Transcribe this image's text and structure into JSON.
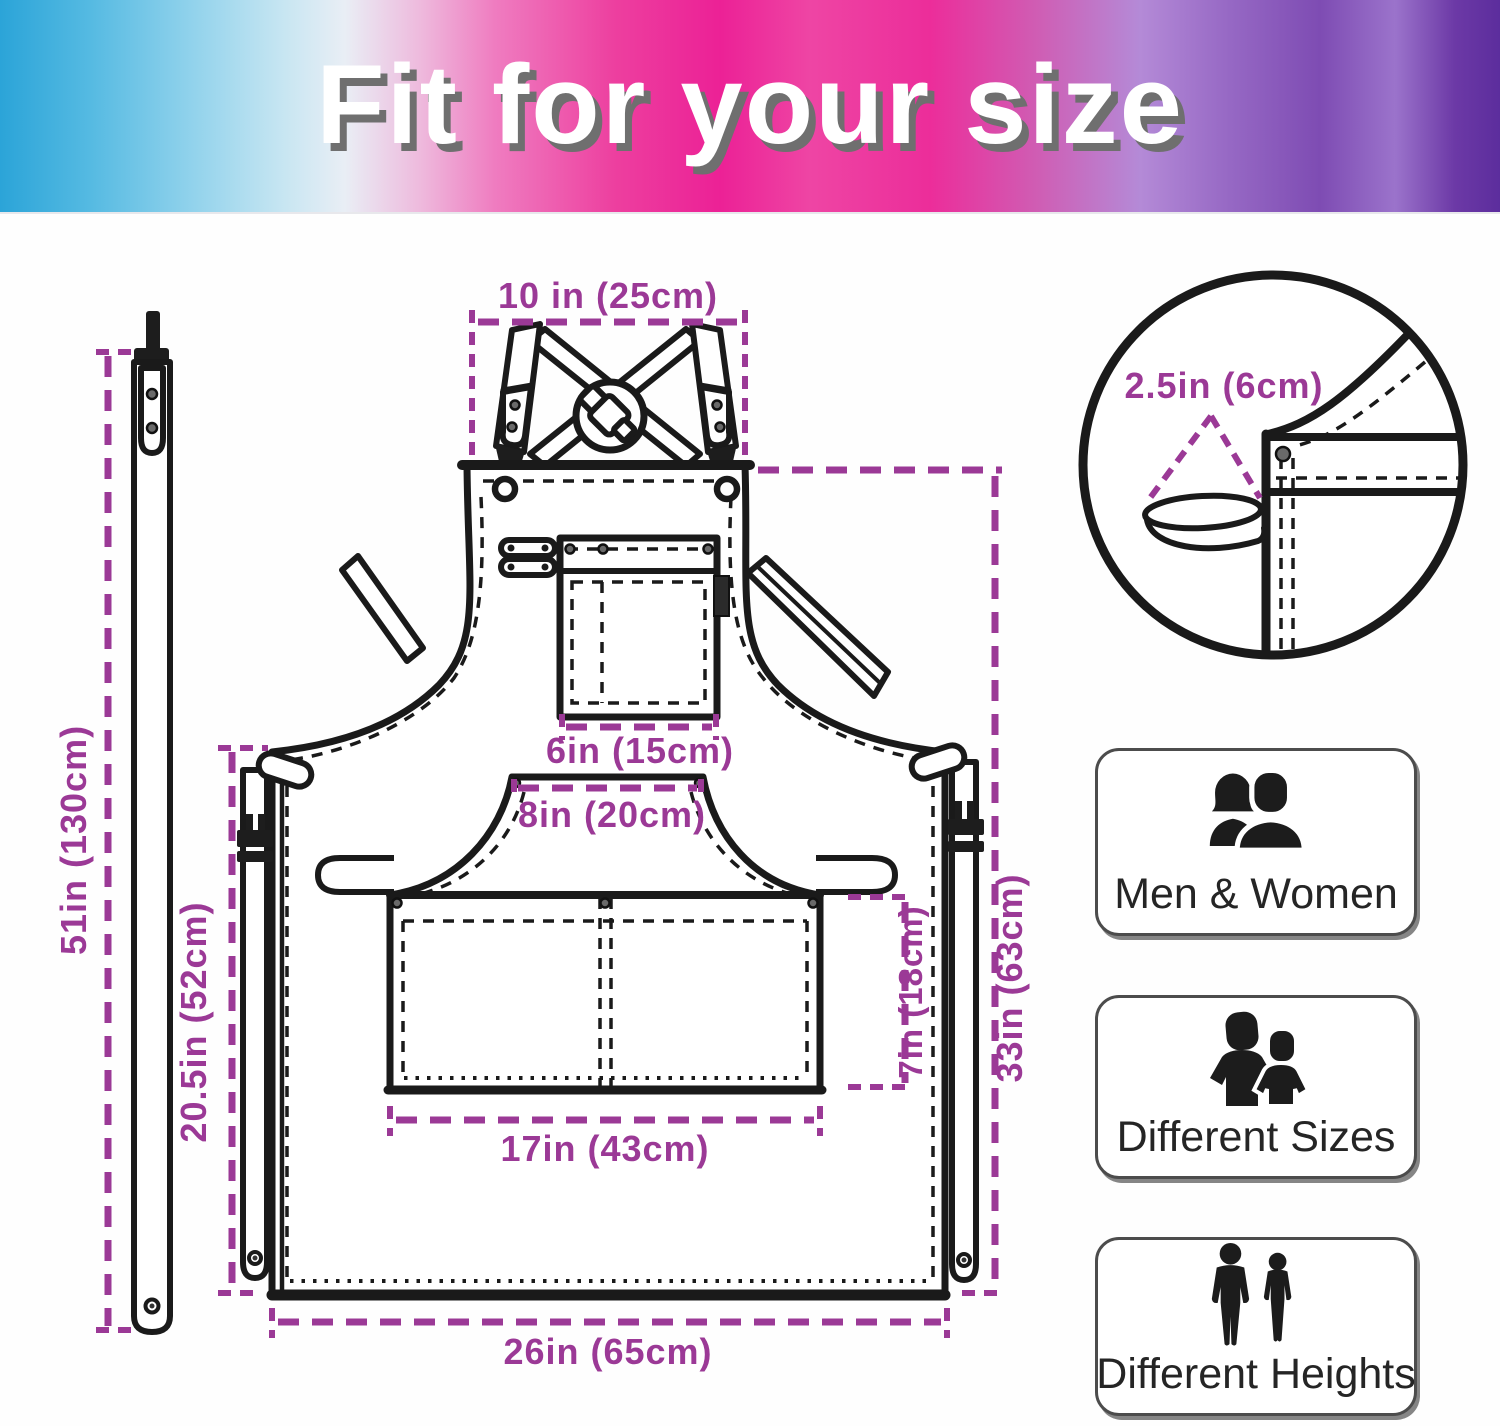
{
  "banner": {
    "title": "Fit for your size"
  },
  "dimensions": {
    "strap_top_width": "10 in (25cm)",
    "loop_size": "2.5in (6cm)",
    "neck_strap_length": "51in (130cm)",
    "waist_to_hem": "20.5in (52cm)",
    "chest_pocket_width": "6in (15cm)",
    "front_pocket_top_width": "8in (20cm)",
    "front_pocket_height": "7in (18cm)",
    "side_length": "33in (63cm)",
    "front_pocket_width": "17in (43cm)",
    "bottom_width": "26in (65cm)"
  },
  "features": [
    {
      "label": "Men & Women"
    },
    {
      "label": "Different Sizes"
    },
    {
      "label": "Different Heights"
    }
  ],
  "colors": {
    "dimension_line": "#9b3996",
    "line_art": "#1a1a1a"
  }
}
